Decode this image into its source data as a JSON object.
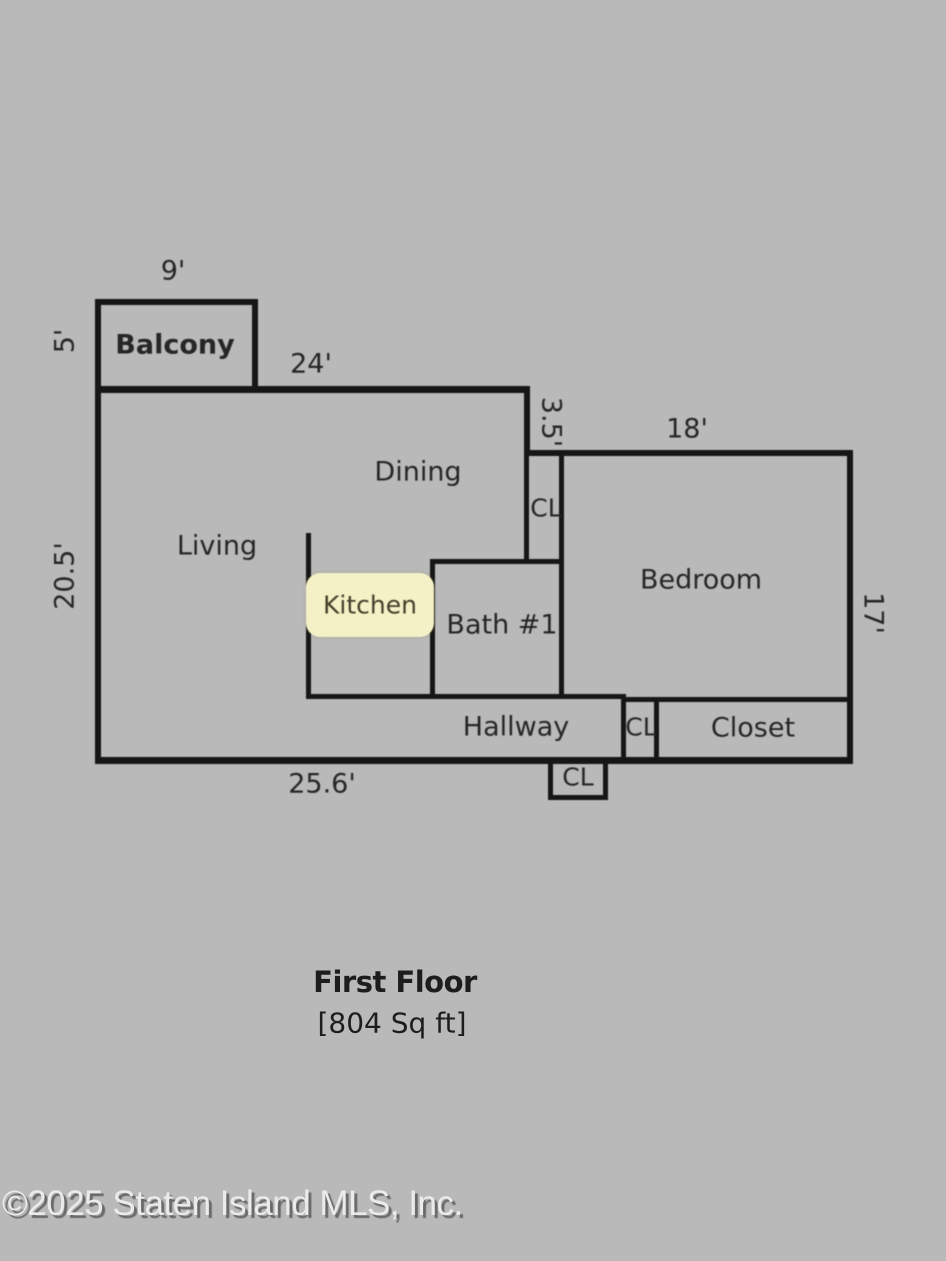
{
  "floorplan": {
    "title": "First Floor",
    "area": "[804 Sq ft]",
    "rooms": [
      {
        "name": "balcony",
        "label": "Balcony"
      },
      {
        "name": "dining",
        "label": "Dining"
      },
      {
        "name": "living",
        "label": "Living"
      },
      {
        "name": "kitchen",
        "label": "Kitchen",
        "highlighted": true
      },
      {
        "name": "bath-1",
        "label": "Bath #1"
      },
      {
        "name": "bedroom",
        "label": "Bedroom"
      },
      {
        "name": "hallway",
        "label": "Hallway"
      },
      {
        "name": "closet",
        "label": "Closet"
      },
      {
        "name": "closet-upper",
        "label": "CL"
      },
      {
        "name": "closet-hall",
        "label": "CL"
      },
      {
        "name": "closet-entry",
        "label": "CL"
      }
    ],
    "dimensions": [
      {
        "name": "balcony-width",
        "label": "9'"
      },
      {
        "name": "balcony-depth",
        "label": "5'"
      },
      {
        "name": "main-top-width",
        "label": "24'"
      },
      {
        "name": "step-depth",
        "label": "3.5'"
      },
      {
        "name": "bedroom-width",
        "label": "18'"
      },
      {
        "name": "left-side-depth",
        "label": "20.5'"
      },
      {
        "name": "bedroom-depth",
        "label": "17'"
      },
      {
        "name": "bottom-width",
        "label": "25.6'"
      }
    ]
  },
  "watermark": {
    "text": "©2025 Staten Island MLS, Inc."
  },
  "colors": {
    "background": "#b9b9b9",
    "wall": "#161616",
    "label_text": "#262626",
    "kitchen_highlight": "#f5f1c6",
    "kitchen_text": "#43412b",
    "watermark_light": "#ebebeb",
    "watermark_shadow": "#696969"
  }
}
